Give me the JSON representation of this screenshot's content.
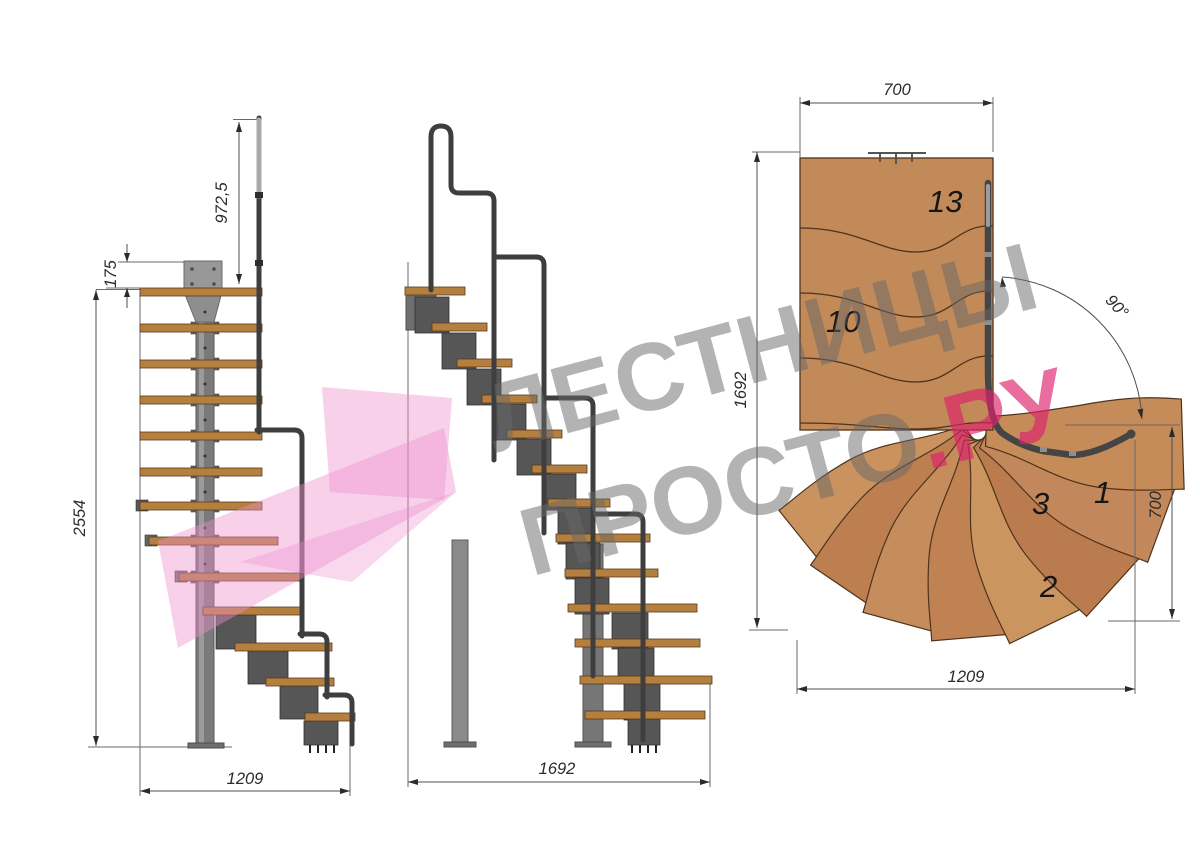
{
  "watermark": {
    "line1": "ЛЕСТНИЦЫ",
    "line2_gray": "ПРОСТО",
    "line2_accent": ".РУ"
  },
  "colors": {
    "wood_plan": "#c18a58",
    "tread_side": "#b5803f",
    "steel": "#6e6e6e",
    "rail": "#3e3e3e",
    "logo_pink": "#ee8fce",
    "watermark_gray": "#8c8c8c",
    "accent_pink_text": "#de226c",
    "dimension": "#2b2b2b"
  },
  "views": {
    "side": {
      "label": "side elevation",
      "dims": {
        "handrail_height": "972,5",
        "top_offset": "175",
        "total_height": "2554",
        "run_length": "1209"
      }
    },
    "front": {
      "label": "front elevation",
      "dims": {
        "run_length": "1692"
      }
    },
    "plan": {
      "label": "plan view",
      "dims": {
        "top_width": "700",
        "depth": "1692",
        "turn_angle": "90°",
        "right_width": "700",
        "bottom_length": "1209"
      },
      "step_numbers": [
        "13",
        "10",
        "3",
        "1",
        "2"
      ]
    }
  }
}
